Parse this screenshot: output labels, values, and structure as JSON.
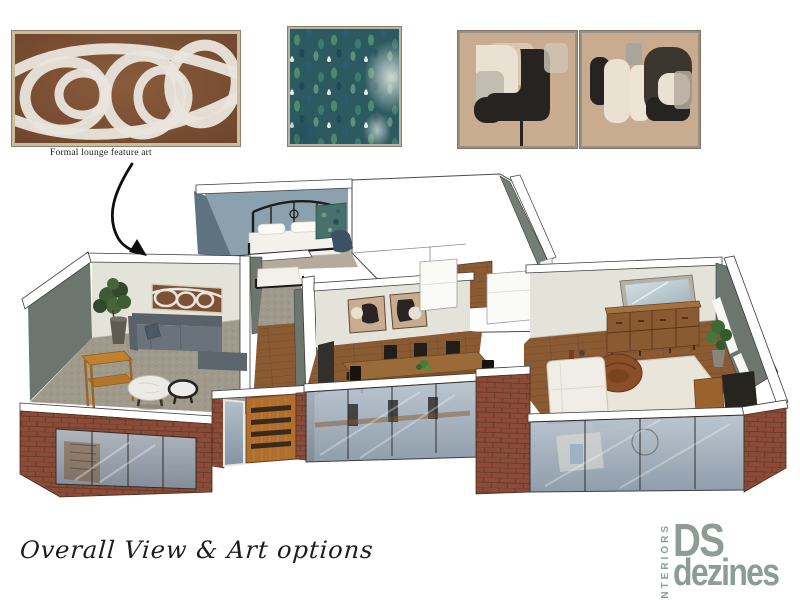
{
  "page": {
    "title": "Overall View & Art options",
    "background_color": "#ffffff"
  },
  "art_options": {
    "feature_art": {
      "caption": "Formal lounge feature art",
      "description": "abstract white swirl strokes on brown canvas, timber frame",
      "canvas_color": "#7c5135",
      "stroke_color": "#e9e5dd",
      "frame_color": "#cabd9e"
    },
    "green_art": {
      "description": "teal green impressionist abstract painting",
      "colors": [
        "#2c5a60",
        "#4d8a6c",
        "#2b5d79",
        "#1f4858",
        "#dfe8dd"
      ]
    },
    "diptych_art": {
      "description": "pair of neutral abstract paintings, black and cream organic shapes on tan",
      "panel_count": 2,
      "colors": [
        "#c9ab8f",
        "#272320",
        "#e9e1d1",
        "#a9a49c"
      ]
    }
  },
  "floor_plan": {
    "description": "3D isometric dollhouse render of apartment",
    "rooms": [
      {
        "name": "formal lounge",
        "furniture": [
          "feature art",
          "grey sofa",
          "potted plant",
          "timber console",
          "round marble coffee tables"
        ]
      },
      {
        "name": "main bedroom",
        "furniture": [
          "black metal bed",
          "white bedding",
          "green artwork",
          "blue armchair"
        ]
      },
      {
        "name": "second bedroom",
        "furniture": [
          "bed on carpet"
        ]
      },
      {
        "name": "dining room",
        "furniture": [
          "timber dining table",
          "black chairs",
          "abstract art pair",
          "plant centerpiece"
        ]
      },
      {
        "name": "kitchen",
        "furniture": [
          "white island bench",
          "white cabinetry"
        ]
      },
      {
        "name": "living room",
        "furniture": [
          "wall mirror",
          "timber sideboard",
          "swivel chair",
          "white sofa",
          "area rug",
          "tv unit",
          "potted plant"
        ]
      }
    ],
    "exterior": [
      "red brick walls",
      "full-height glazing",
      "timber slat entry door"
    ]
  },
  "annotation": {
    "arrow": "from feature art caption to formal lounge wall"
  },
  "logo": {
    "vertical_text": "INTERIORS",
    "line1": "DS",
    "line2": "dezines",
    "color": "#8d9c94"
  }
}
